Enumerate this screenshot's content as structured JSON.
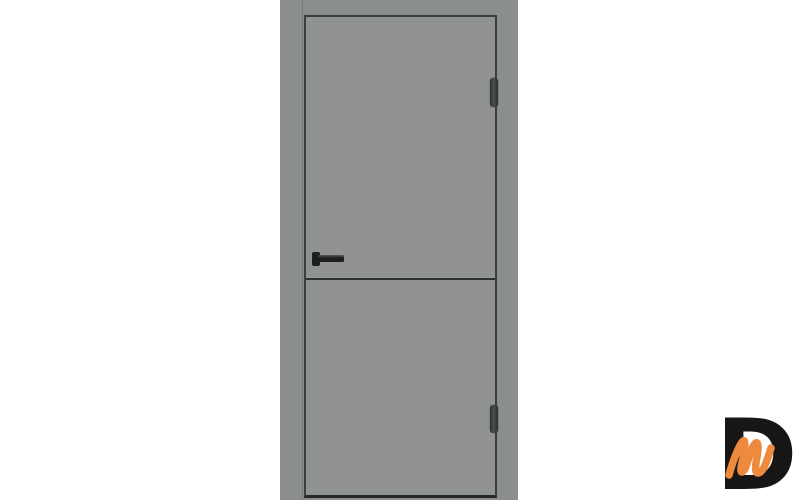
{
  "image": {
    "type": "product-photo",
    "subject": "Gray interior door, closed, front view on white background",
    "door": {
      "panels": 2,
      "hinge_count": 2,
      "hinge_side": "right",
      "handle_side": "left",
      "handle_style": "black lever on square rosette"
    }
  },
  "colors": {
    "bg": "#ffffff",
    "frame": "#8a8e8c",
    "leaf": "#90938f",
    "gap-line": "#3a3e3c",
    "bottom-line": "#232725",
    "groove": "#2c302e",
    "handle": "#1d1f1e",
    "handle-highlight": "#555755",
    "hinge": "#4b504d",
    "hinge-edge": "#2b2f2d",
    "logo-d": "#161616",
    "logo-m": "#ee8a3d"
  },
  "logo": {
    "letter_d": "D",
    "letter_m": "m"
  }
}
